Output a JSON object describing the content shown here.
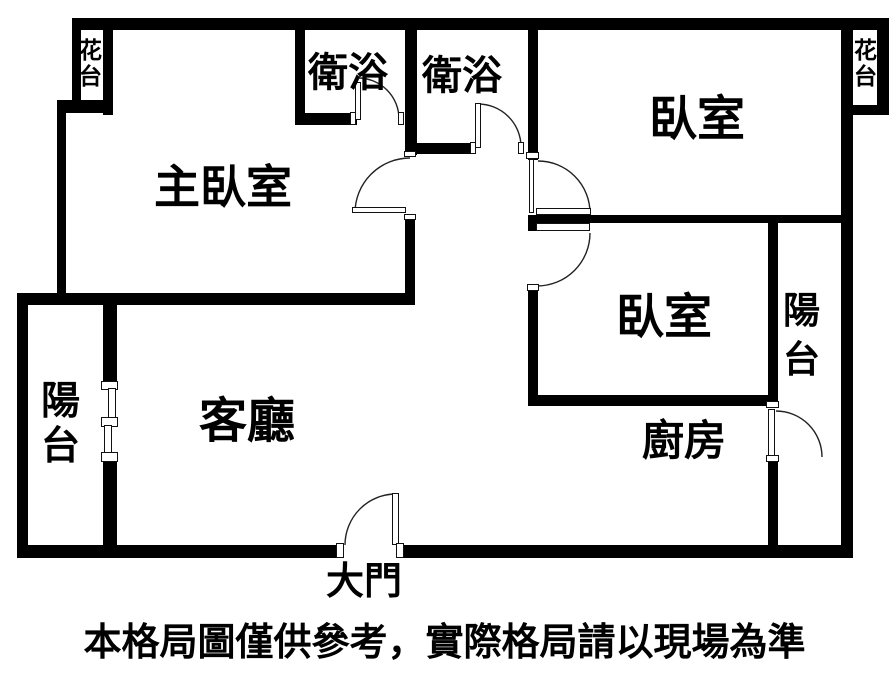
{
  "floorplan": {
    "rooms": {
      "master_bedroom": "主臥室",
      "bedroom_top_right": "臥室",
      "bedroom_mid_right": "臥室",
      "living_room": "客廳",
      "kitchen": "廚房",
      "bathroom_1": "衛浴",
      "bathroom_2": "衛浴",
      "balcony_left": "陽台",
      "balcony_right": "陽台",
      "flower_bed_left": "花台",
      "flower_bed_right": "花台"
    },
    "entrance_label": "大門",
    "disclaimer": "本格局圖僅供參考，實際格局請以現場為準",
    "colors": {
      "wall": "#000000",
      "background": "#ffffff"
    }
  }
}
